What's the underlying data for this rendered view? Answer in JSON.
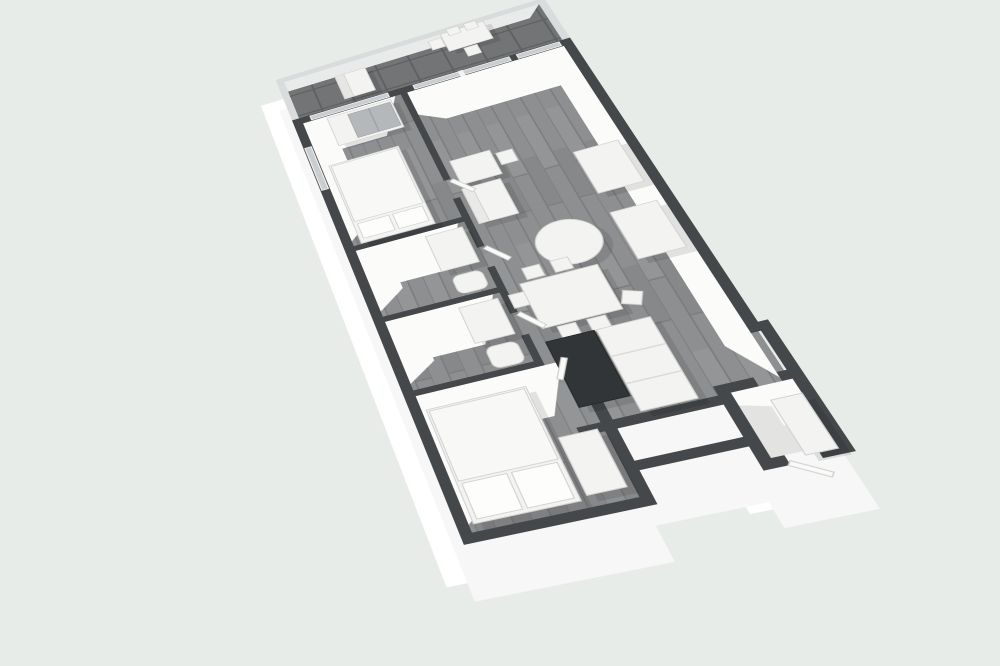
{
  "meta": {
    "title": "3d-apartment-floor-plan-render",
    "view": "axonometric-top-down"
  },
  "canvas": {
    "width": 1000,
    "height": 666,
    "background": "#e8ece9"
  },
  "palette": {
    "background": "#e8ece9",
    "wall_top": "#45484a",
    "wall_face_white": "#fbfbfa",
    "exterior_slab": "#ffffff",
    "exterior_slab_2": "#f6f7f6",
    "wood_floor": "#8e8f90",
    "balcony_tile": "#737475",
    "glass": "#c9ced1",
    "parapet": "#d9dcdc",
    "furniture_white": "#f3f3f1",
    "furniture_stroke": "#d4d4d2",
    "kitchen_dark": "#323537",
    "mirror_gray": "#b4b8ba",
    "vestibule_floor": "#e3e3e1",
    "shadow": "rgba(0,0,0,0.10)"
  },
  "projection": {
    "plan_width": 310,
    "plan_height": 662,
    "matrix3d": "matrix3d(0.8053,-0.2738,0,-0.0001624, 0.0971,0.4891,0,-0.000415, 0,0,1,0, 275.63,80,0,1)"
  },
  "outline_path": "M0,75 L300,75 L300,495 L308,495 L308,640 L240,640 L240,615 L155,615 L155,650 L0,650 Z",
  "balcony_path": "M0,0 L300,0 L300,75 L0,75 Z",
  "silhouettes": [
    {
      "name": "wall-extrusion-far",
      "dx": -26,
      "dy": 36,
      "fill": "#ffffff"
    },
    {
      "name": "wall-extrusion-near",
      "dx": -9,
      "dy": 54,
      "fill": "#f6f7f6"
    }
  ],
  "parapet": [
    {
      "name": "balcony-parapet-north",
      "r": [
        0,
        0,
        300,
        8
      ]
    },
    {
      "name": "balcony-parapet-west",
      "r": [
        0,
        0,
        8,
        75
      ]
    },
    {
      "name": "balcony-parapet-east",
      "r": [
        292,
        0,
        8,
        75
      ]
    }
  ],
  "floors": [
    {
      "name": "balcony-floor",
      "r": [
        8,
        8,
        284,
        67
      ],
      "f": "tile"
    },
    {
      "name": "main-floor",
      "r": [
        10,
        85,
        286,
        485
      ],
      "f": "wood"
    },
    {
      "name": "bedroom2-floor",
      "r": [
        10,
        570,
        135,
        70
      ],
      "f": "wood"
    },
    {
      "name": "vestibule-floor",
      "r": [
        250,
        560,
        48,
        70
      ],
      "f": "#e3e3e1"
    }
  ],
  "wall_faces": [
    {
      "name": "bedroom1-wall-face",
      "pts": [
        [
          10,
          85
        ],
        [
          112,
          85
        ],
        [
          86,
          142
        ],
        [
          38,
          142
        ],
        [
          38,
          252
        ],
        [
          10,
          278
        ]
      ]
    },
    {
      "name": "bath1-wall-face",
      "pts": [
        [
          10,
          292
        ],
        [
          112,
          292
        ],
        [
          86,
          348
        ],
        [
          38,
          348
        ],
        [
          38,
          356
        ],
        [
          10,
          378
        ]
      ]
    },
    {
      "name": "bath2-wall-face",
      "pts": [
        [
          10,
          392
        ],
        [
          112,
          392
        ],
        [
          86,
          448
        ],
        [
          38,
          448
        ],
        [
          38,
          452
        ],
        [
          10,
          472
        ]
      ]
    },
    {
      "name": "bedroom2-wall-face",
      "pts": [
        [
          10,
          487
        ],
        [
          139,
          487
        ],
        [
          113,
          543
        ],
        [
          38,
          543
        ],
        [
          38,
          608
        ],
        [
          10,
          632
        ]
      ]
    },
    {
      "name": "living-wall-face",
      "pts": [
        [
          125,
          85
        ],
        [
          290,
          85
        ],
        [
          290,
          556
        ],
        [
          266,
          512
        ],
        [
          266,
          142
        ],
        [
          149,
          142
        ],
        [
          125,
          124
        ]
      ]
    },
    {
      "name": "vestibule-wall-face",
      "pts": [
        [
          250,
          560
        ],
        [
          298,
          560
        ],
        [
          298,
          628
        ],
        [
          272,
          602
        ],
        [
          272,
          582
        ],
        [
          250,
          574
        ]
      ]
    },
    {
      "name": "balcony-inner-face",
      "pts": [
        [
          8,
          8
        ],
        [
          292,
          8
        ],
        [
          276,
          26
        ],
        [
          8,
          26
        ]
      ],
      "f": "#e9ebeb"
    }
  ],
  "walls": [
    {
      "name": "wall-north-exterior",
      "r": [
        0,
        75,
        300,
        10
      ]
    },
    {
      "name": "wall-west-exterior",
      "r": [
        0,
        75,
        10,
        575
      ]
    },
    {
      "name": "wall-south-exterior",
      "r": [
        0,
        640,
        155,
        10
      ]
    },
    {
      "name": "wall-bedroom2-east",
      "r": [
        145,
        487,
        10,
        163
      ]
    },
    {
      "name": "wall-notch-north",
      "r": [
        145,
        605,
        105,
        10
      ]
    },
    {
      "name": "wall-vestibule-west",
      "r": [
        240,
        550,
        10,
        90
      ]
    },
    {
      "name": "wall-vestibule-north-a",
      "r": [
        250,
        550,
        22,
        10
      ]
    },
    {
      "name": "wall-vestibule-north-b",
      "r": [
        290,
        550,
        18,
        10
      ]
    },
    {
      "name": "wall-vestibule-south-a",
      "r": [
        250,
        630,
        10,
        10
      ]
    },
    {
      "name": "wall-vestibule-south-b",
      "r": [
        284,
        630,
        24,
        10
      ]
    },
    {
      "name": "wall-east-upper",
      "r": [
        290,
        75,
        10,
        430
      ]
    },
    {
      "name": "wall-east-step",
      "r": [
        290,
        495,
        18,
        10
      ]
    },
    {
      "name": "wall-east-lower",
      "r": [
        298,
        505,
        10,
        135
      ]
    },
    {
      "name": "wall-spine-a",
      "r": [
        118,
        85,
        7,
        145
      ]
    },
    {
      "name": "wall-spine-b",
      "r": [
        118,
        258,
        7,
        72
      ]
    },
    {
      "name": "wall-spine-c",
      "r": [
        118,
        358,
        7,
        62
      ]
    },
    {
      "name": "wall-spine-d",
      "r": [
        118,
        448,
        7,
        39
      ]
    },
    {
      "name": "wall-bedroom1-bath1",
      "r": [
        10,
        285,
        108,
        7
      ]
    },
    {
      "name": "wall-bath1-bath2",
      "r": [
        10,
        385,
        108,
        7
      ]
    },
    {
      "name": "wall-bath2-bedroom2-a",
      "r": [
        10,
        480,
        108,
        7
      ]
    },
    {
      "name": "wall-bath2-bedroom2-b",
      "r": [
        143,
        480,
        12,
        7
      ]
    },
    {
      "name": "wall-kitchen-south",
      "r": [
        125,
        560,
        125,
        10
      ]
    }
  ],
  "glass": [
    {
      "name": "window-bedroom1",
      "r": [
        20,
        76.5,
        86,
        7
      ]
    },
    {
      "name": "window-living",
      "r": [
        134,
        76.5,
        102,
        7
      ]
    },
    {
      "name": "window-living-east",
      "r": [
        244,
        76.5,
        44,
        7
      ]
    },
    {
      "name": "window-mullion",
      "r": [
        183,
        76,
        4,
        9
      ],
      "f": "#f4f4f4"
    },
    {
      "name": "window-bedroom1-west",
      "r": [
        1.5,
        125,
        7,
        70
      ]
    }
  ],
  "furniture": [
    {
      "name": "lounge-chair",
      "r": [
        62,
        25,
        34,
        41
      ],
      "sh": 1
    },
    {
      "name": "lounge-chair-back",
      "r": [
        62,
        25,
        10,
        41
      ],
      "f": "#e6e6e4"
    },
    {
      "name": "balcony-table",
      "r": [
        185,
        8,
        47,
        32
      ],
      "sh": 1
    },
    {
      "name": "balcony-chair-1",
      "r": [
        170,
        14,
        14,
        16
      ]
    },
    {
      "name": "balcony-chair-2",
      "r": [
        193,
        3,
        13,
        12
      ]
    },
    {
      "name": "balcony-chair-3",
      "r": [
        212,
        3,
        13,
        12
      ]
    },
    {
      "name": "balcony-chair-4",
      "r": [
        200,
        42,
        14,
        15
      ]
    },
    {
      "name": "wardrobe",
      "r": [
        36,
        88,
        70,
        48
      ],
      "sh": 1
    },
    {
      "name": "wardrobe-mirror",
      "r": [
        58,
        92,
        46,
        40
      ],
      "f": "#b4b8ba",
      "sk": "#a6aaac"
    },
    {
      "name": "wardrobe-divider",
      "r": [
        80,
        92,
        1.5,
        40
      ],
      "f": "#9fa3a5",
      "sk": "none"
    },
    {
      "name": "bed1-frame",
      "r": [
        18,
        162,
        74,
        122
      ],
      "sh": 1
    },
    {
      "name": "bed1-duvet",
      "r": [
        20,
        164,
        70,
        88
      ],
      "f": "#f8f8f6"
    },
    {
      "name": "bed1-pillow-1",
      "r": [
        22,
        256,
        32,
        22
      ],
      "f": "#fdfdfc"
    },
    {
      "name": "bed1-pillow-2",
      "r": [
        58,
        256,
        30,
        22
      ],
      "f": "#fdfdfc"
    },
    {
      "name": "desk",
      "r": [
        132,
        205,
        40,
        37
      ],
      "sh": 1
    },
    {
      "name": "desk-chair",
      "r": [
        176,
        212,
        16,
        18
      ]
    },
    {
      "name": "sofa",
      "r": [
        130,
        248,
        38,
        52
      ],
      "sh": 1
    },
    {
      "name": "sofa-back",
      "r": [
        130,
        248,
        10,
        52
      ],
      "f": "#e9e9e7"
    },
    {
      "name": "coffee-table",
      "k": "circle",
      "c": [
        196,
        352
      ],
      "rad": 29,
      "sh": 1
    },
    {
      "name": "sideboard-1",
      "r": [
        242,
        240,
        42,
        62
      ],
      "sh": 1
    },
    {
      "name": "sideboard-2",
      "r": [
        242,
        330,
        42,
        64
      ],
      "sh": 1
    },
    {
      "name": "dining-table",
      "r": [
        138,
        388,
        70,
        58
      ],
      "sh": 1
    },
    {
      "name": "dining-chair-1",
      "r": [
        146,
        370,
        16,
        15
      ]
    },
    {
      "name": "dining-chair-2",
      "r": [
        172,
        370,
        16,
        15
      ]
    },
    {
      "name": "dining-chair-3",
      "r": [
        150,
        448,
        16,
        15
      ]
    },
    {
      "name": "dining-chair-4",
      "r": [
        176,
        448,
        16,
        15
      ]
    },
    {
      "name": "dining-chair-5",
      "r": [
        124,
        398,
        14,
        17
      ]
    },
    {
      "name": "dining-chair-6",
      "r": [
        212,
        428,
        16,
        16
      ],
      "rot": [
        25,
        220,
        436
      ]
    },
    {
      "name": "kitchen-counter-dark",
      "r": [
        135,
        462,
        42,
        78
      ],
      "f": "#323537",
      "sk": "#26292b",
      "sh": 1
    },
    {
      "name": "kitchen-cabinets",
      "r": [
        179,
        462,
        46,
        96
      ],
      "sh": 1
    },
    {
      "name": "kitchen-seam-1",
      "r": [
        179,
        494,
        46,
        1.5
      ],
      "f": "#dadad8",
      "sk": "none"
    },
    {
      "name": "kitchen-seam-2",
      "r": [
        179,
        526,
        46,
        1.5
      ],
      "f": "#dadad8",
      "sk": "none"
    },
    {
      "name": "bath1-vanity",
      "r": [
        78,
        298,
        36,
        50
      ],
      "sh": 1
    },
    {
      "name": "bath1-toilet",
      "r": [
        84,
        358,
        28,
        24
      ],
      "rx": 7
    },
    {
      "name": "bath2-vanity",
      "r": [
        78,
        398,
        36,
        46
      ],
      "sh": 1
    },
    {
      "name": "bath2-toilet",
      "r": [
        84,
        452,
        28,
        26
      ],
      "rx": 7
    },
    {
      "name": "bed2-frame",
      "r": [
        14,
        505,
        88,
        127
      ],
      "sh": 1
    },
    {
      "name": "bed2-duvet",
      "r": [
        16,
        507,
        84,
        80
      ],
      "f": "#f8f8f6"
    },
    {
      "name": "bed2-pillow-1",
      "r": [
        18,
        590,
        38,
        38
      ],
      "f": "#fdfdfc"
    },
    {
      "name": "bed2-pillow-2",
      "r": [
        60,
        590,
        38,
        38
      ],
      "f": "#fdfdfc"
    },
    {
      "name": "bed2-dresser",
      "r": [
        108,
        566,
        32,
        62
      ],
      "sh": 1
    },
    {
      "name": "entry-closet",
      "r": [
        274,
        576,
        24,
        58
      ],
      "sh": 1
    }
  ],
  "doors": [
    {
      "name": "bedroom1-door",
      "h": [
        125,
        232
      ],
      "len": 27,
      "a": 55
    },
    {
      "name": "bath1-door",
      "h": [
        125,
        332
      ],
      "len": 27,
      "a": 55
    },
    {
      "name": "bath2-door",
      "h": [
        125,
        422
      ],
      "len": 27,
      "a": 55
    },
    {
      "name": "bedroom2-door",
      "h": [
        143,
        484
      ],
      "len": 25,
      "a": 118
    },
    {
      "name": "entry-door",
      "h": [
        260,
        638
      ],
      "len": 30,
      "a": 38
    }
  ],
  "rooms": [
    {
      "name": "balcony"
    },
    {
      "name": "bedroom-1"
    },
    {
      "name": "bathroom-1"
    },
    {
      "name": "bathroom-2"
    },
    {
      "name": "bedroom-2"
    },
    {
      "name": "living-dining-kitchen"
    },
    {
      "name": "hallway"
    },
    {
      "name": "entry-vestibule"
    }
  ]
}
